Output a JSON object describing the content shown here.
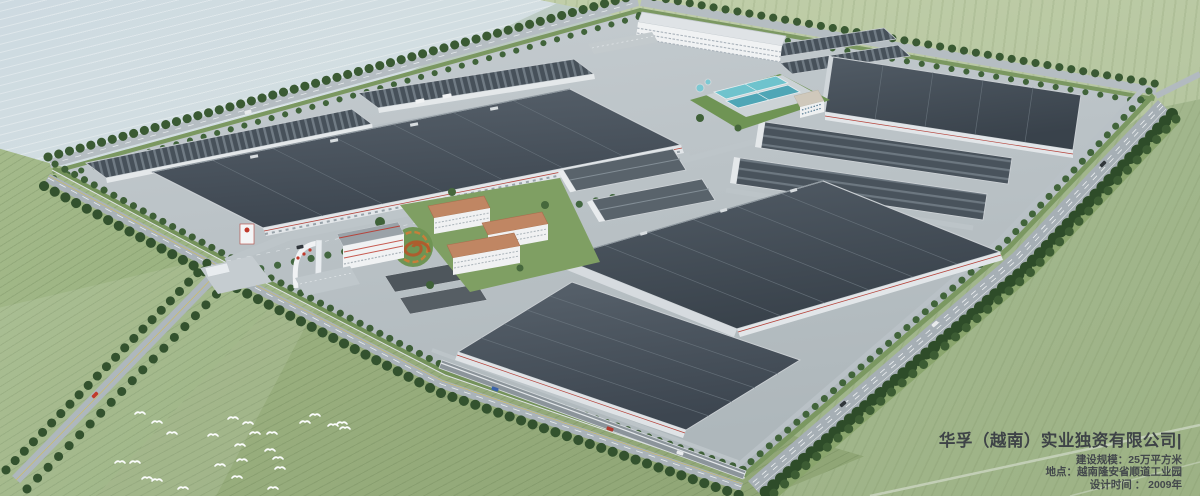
{
  "caption": {
    "title": "华孚（越南）实业独资有限公司|",
    "lines": [
      "建设规模：25万平方米",
      "地点：越南隆安省顺道工业园",
      "设计时间 ： 2009年"
    ]
  },
  "scene": {
    "description": "Aerial rendering of a large industrial park: dark-roofed factory halls, dormitory slab, water-treatment pools, orange-roofed staff buildings, spiral garden, gate arch, tree-lined perimeter roads, flock of white birds over fields",
    "colors": {
      "factory_roof": "#47515a",
      "roof_seam": "#707b84",
      "facade_white": "#e3e7ea",
      "accent_red": "#b5443c",
      "road_gray": "#aab3b9",
      "tree_green": "#33522e",
      "field_green": "#9cb282",
      "pool_teal": "#6fc3cd",
      "orange_roof": "#c08663",
      "caption_text": "#3e4347"
    }
  }
}
